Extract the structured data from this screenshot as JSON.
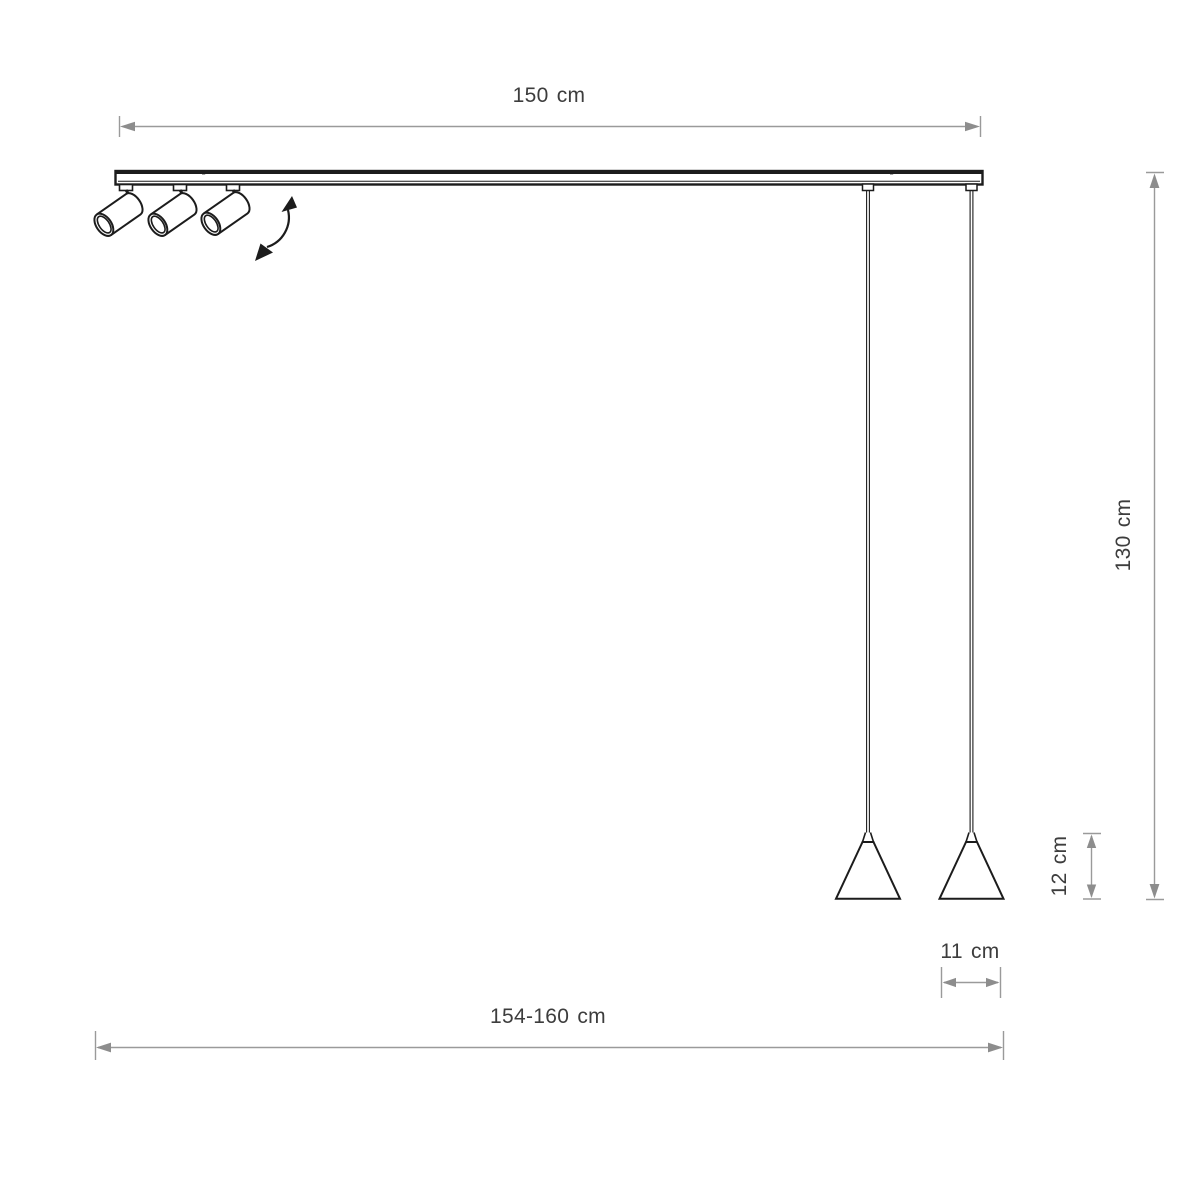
{
  "diagram": {
    "name": "pendant-track-lamp-dimension-drawing",
    "dimensions": {
      "track_length": "150 cm",
      "suspension_height": "130 cm",
      "shade_height": "12 cm",
      "shade_diameter": "11 cm",
      "overall_length": "154-160 cm"
    },
    "parts": {
      "spotlight_count": 3,
      "pendant_count": 2
    },
    "colors": {
      "outline": "#1c1c1c",
      "dimension_line": "#9a9a9a",
      "arrowhead": "#8d8d8d",
      "label_text": "#3d3d3d",
      "background": "#ffffff"
    }
  }
}
